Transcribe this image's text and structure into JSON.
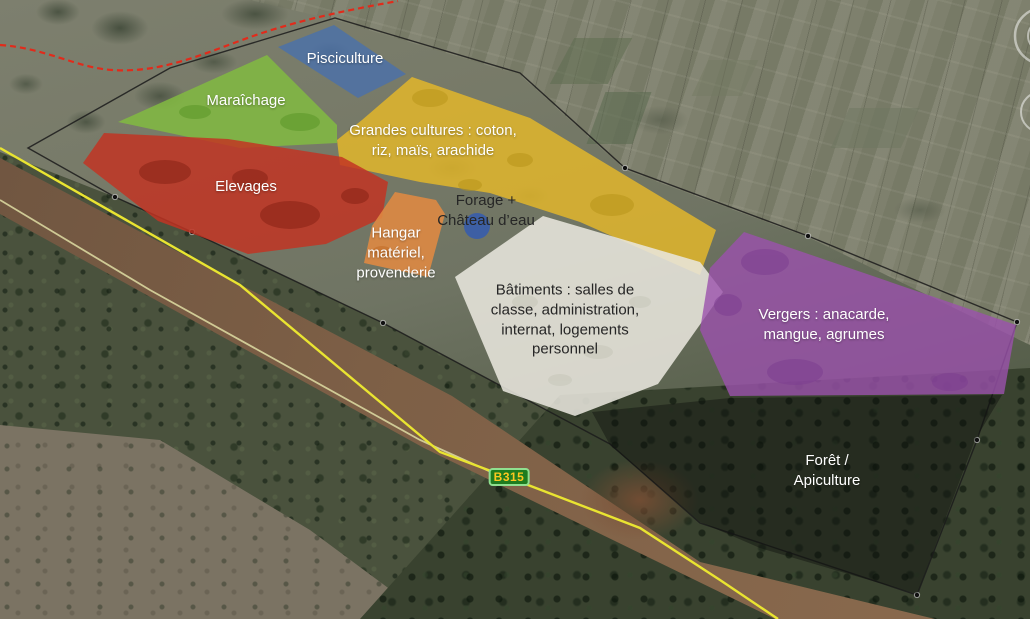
{
  "map": {
    "zones": [
      {
        "id": "pisciculture",
        "label": "Pisciculture",
        "color": "#4a71ab",
        "text_color": "#ffffff"
      },
      {
        "id": "maraichage",
        "label": "Maraîchage",
        "color": "#82bb40",
        "text_color": "#ffffff"
      },
      {
        "id": "grandes-cultures",
        "label": "Grandes cultures : coton,\nriz, maïs, arachide",
        "color": "#e2b62b",
        "text_color": "#ffffff"
      },
      {
        "id": "elevages",
        "label": "Elevages",
        "color": "#c23322",
        "text_color": "#ffffff"
      },
      {
        "id": "hangar",
        "label": "Hangar\nmatériel,\nprovenderie",
        "color": "#e08a42",
        "text_color": "#ffffff"
      },
      {
        "id": "forage",
        "label": "Forage +\nChâteau d’eau",
        "color": "#3a5ea8",
        "text_color": "#262626"
      },
      {
        "id": "batiments",
        "label": "Bâtiments : salles de\nclasse, administration,\ninternat, logements\npersonnel",
        "color": "#e9e7de",
        "text_color": "#262626"
      },
      {
        "id": "vergers",
        "label": "Vergers : anacarde,\nmangue, agrumes",
        "color": "#9b51ad",
        "text_color": "#ffffff"
      },
      {
        "id": "foret",
        "label": "Forêt /\nApiculture",
        "color": "#0c0f0c",
        "text_color": "#ffffff"
      }
    ],
    "road_sign": {
      "label": "B315",
      "fill_color": "#1f7c1f",
      "border_color": "#8fe08f",
      "text_color": "#fdc71f"
    },
    "lines": {
      "boundary_color": "#1b1b1b",
      "main_road_color": "#e9e431",
      "side_road_color": "#d9d69e",
      "red_track_color": "#e12b1b"
    }
  }
}
